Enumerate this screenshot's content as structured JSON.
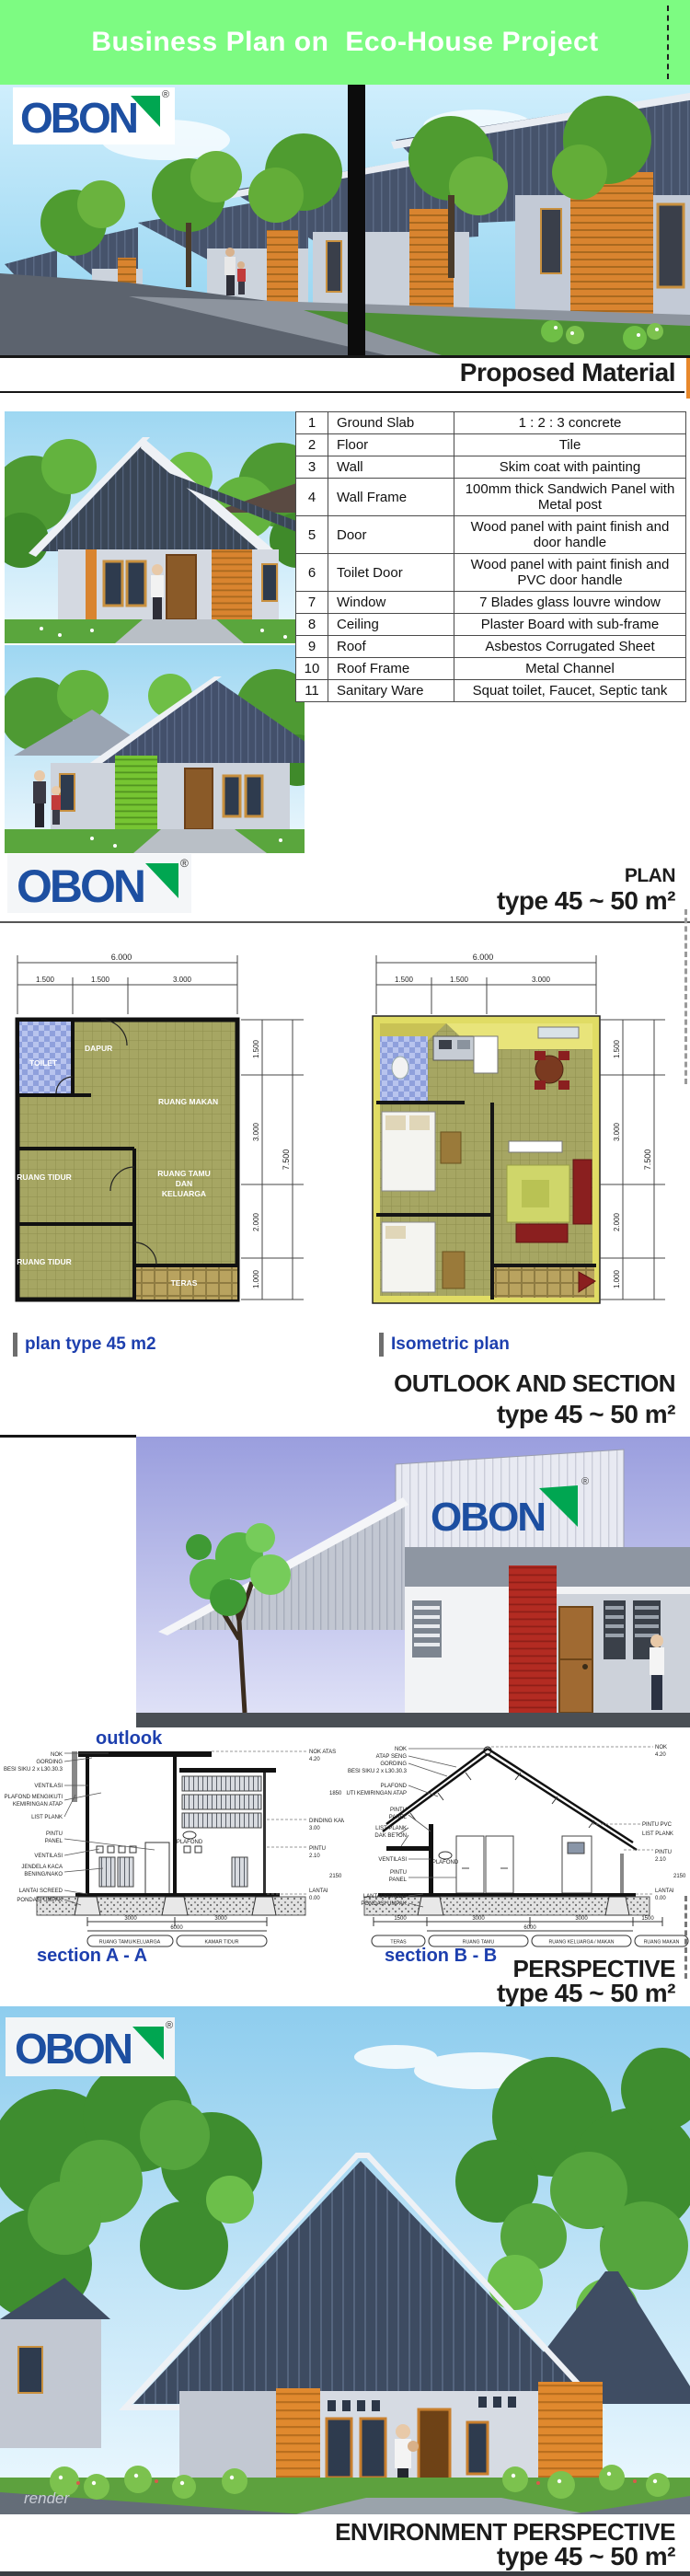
{
  "header": {
    "title_left": "Business Plan on",
    "title_right": "Eco-House Project"
  },
  "brand": {
    "name": "OBON",
    "registered": "®"
  },
  "material_section": {
    "heading": "Proposed Material",
    "rows": [
      {
        "no": "1",
        "item": "Ground Slab",
        "desc": "1 : 2 : 3 concrete"
      },
      {
        "no": "2",
        "item": "Floor",
        "desc": "Tile"
      },
      {
        "no": "3",
        "item": "Wall",
        "desc": "Skim coat with painting"
      },
      {
        "no": "4",
        "item": "Wall Frame",
        "desc": "100mm thick Sandwich Panel with Metal post"
      },
      {
        "no": "5",
        "item": "Door",
        "desc": "Wood panel with paint finish and door handle"
      },
      {
        "no": "6",
        "item": "Toilet Door",
        "desc": "Wood panel with paint finish and PVC door handle"
      },
      {
        "no": "7",
        "item": "Window",
        "desc": "7 Blades  glass louvre window"
      },
      {
        "no": "8",
        "item": "Ceiling",
        "desc": "Plaster Board with sub-frame"
      },
      {
        "no": "9",
        "item": "Roof",
        "desc": "Asbestos  Corrugated Sheet"
      },
      {
        "no": "10",
        "item": "Roof Frame",
        "desc": "Metal Channel"
      },
      {
        "no": "11",
        "item": "Sanitary Ware",
        "desc": "Squat toilet, Faucet, Septic tank"
      }
    ]
  },
  "plan_section": {
    "heading_top": "PLAN",
    "heading_type": "type 45 ~ 50 m²",
    "left_caption": "plan type 45 m2",
    "right_caption": "Isometric plan",
    "dims": {
      "overall_w": "6.000",
      "w1": "1.500",
      "w2": "1.500",
      "w3": "3.000",
      "overall_h": "7.500",
      "h1": "1.500",
      "h2": "3.000",
      "h3": "2.000",
      "h4": "1.000"
    },
    "rooms": {
      "toilet": "TOILET",
      "dapur": "DAPUR",
      "ruang_makan": "RUANG MAKAN",
      "ruang_tidur_1": "RUANG TIDUR",
      "ruang_tamu_1": "RUANG TAMU",
      "ruang_tamu_2": "DAN",
      "ruang_tamu_3": "KELUARGA",
      "ruang_tidur_2": "RUANG TIDUR",
      "teras": "TERAS"
    }
  },
  "outlook_section": {
    "heading_top": "OUTLOOK AND SECTION",
    "heading_type": "type 45 ~ 50 m²",
    "caption": "outlook"
  },
  "section_a": {
    "caption": "section A - A",
    "left_labels": [
      "NOK",
      "GORDING",
      "BESI SIKU 2 x L30.30.3",
      "VENTILASI",
      "PLAFOND MENGIKUTI",
      "KEMIRINGAN ATAP",
      "LIST PLANK",
      "PINTU",
      "PANEL",
      "VENTILASI",
      "JENDELA KACA",
      "BENING/NAKO",
      "LANTAI SCREED",
      "PONDASI UMPAK"
    ],
    "mid_label": "PLAFOND",
    "right_labels": [
      "NOK ATAS",
      "4.20",
      "1850",
      "DINDING KAMAR",
      "3.00",
      "PINTU",
      "2.10",
      "2150",
      "LANTAI",
      "0.00"
    ],
    "dim_segments": [
      "3000",
      "3000"
    ],
    "dim_total": "6000",
    "room_tags": [
      "RUANG TAMU/KELUARGA",
      "KAMAR TIDUR"
    ]
  },
  "section_b": {
    "caption": "section B - B",
    "left_labels": [
      "NOK",
      "ATAP SENG",
      "GORDING",
      "BESI SIKU 2 x L30.30.3",
      "PLAFOND",
      "MENGIKUTI KEMIRINGAN ATAP",
      "PINTU",
      "PANEL",
      "LIST PLANK",
      "DAK BETON",
      "VENTILASI",
      "PINTU",
      "PANEL",
      "LANTAI SCREED",
      "PONDASI UMPAK"
    ],
    "mid_label": "PLAFOND",
    "right_labels": [
      "NOK",
      "4.20",
      "PINTU PVC",
      "LIST PLANK",
      "PINTU",
      "2.10",
      "2150",
      "LANTAI",
      "0.00"
    ],
    "dim_segments": [
      "1500",
      "3000",
      "3000",
      "1500"
    ],
    "dim_total": "6000",
    "room_tags": [
      "TERAS",
      "RUANG TAMU",
      "RUANG KELUARGA / MAKAN",
      "RUANG MAKAN"
    ]
  },
  "perspective_section": {
    "heading_top": "PERSPECTIVE",
    "heading_type": "type 45 ~ 50 m²",
    "watermark": "render"
  },
  "environment_section": {
    "heading_top": "ENVIRONMENT PERSPECTIVE",
    "heading_type": "type 45 ~ 50 m²"
  },
  "colors": {
    "header_green": "#7dfb82",
    "obon_blue": "#1d4fa1",
    "obon_green": "#00a651",
    "accent_orange": "#e0892e",
    "panel_green": "#76c532",
    "caption_blue": "#1d3fae",
    "roof_dark": "#3d4b61",
    "plan_floor_olive": "#a6a663",
    "toilet_blue": "#8fa0dc",
    "iso_wall_yellow": "#e0dc64",
    "outlook_red_wall": "#b32b22"
  }
}
